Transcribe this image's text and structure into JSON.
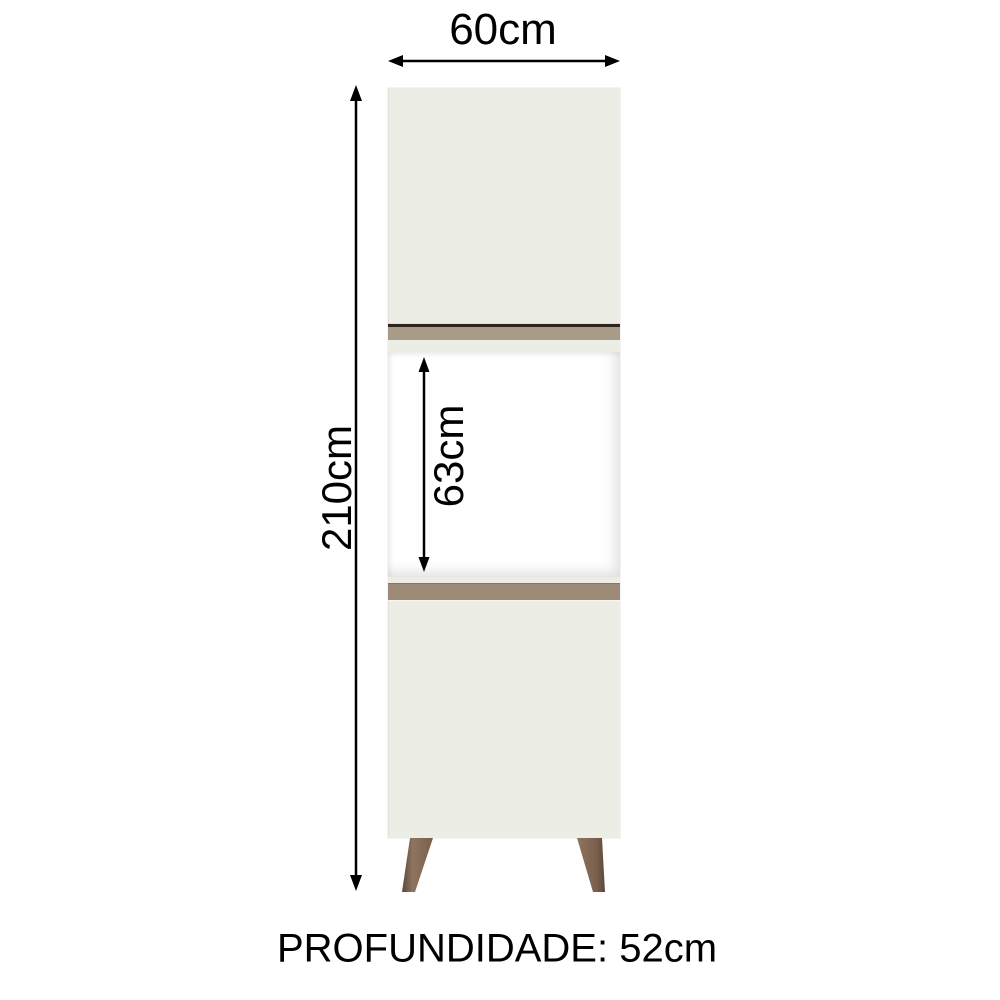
{
  "diagram": {
    "type": "product-dimension-diagram",
    "product": "oven tower cabinet with two doors and open oven niche",
    "labels": {
      "width": "60cm",
      "height": "210cm",
      "opening_height": "63cm",
      "depth": "PROFUNDIDADE: 52cm"
    },
    "colors": {
      "cabinet": "#ecede5",
      "cabinet_edge": "#d8d9d0",
      "opening": "#ffffff",
      "strip_top": "#a89c89",
      "strip_top_line": "#2e251b",
      "strip_bottom": "#9d8b77",
      "leg_light": "#8f7560",
      "leg_dark": "#5c4737",
      "arrow": "#000000",
      "text": "#000000",
      "background": "#ffffff"
    }
  }
}
